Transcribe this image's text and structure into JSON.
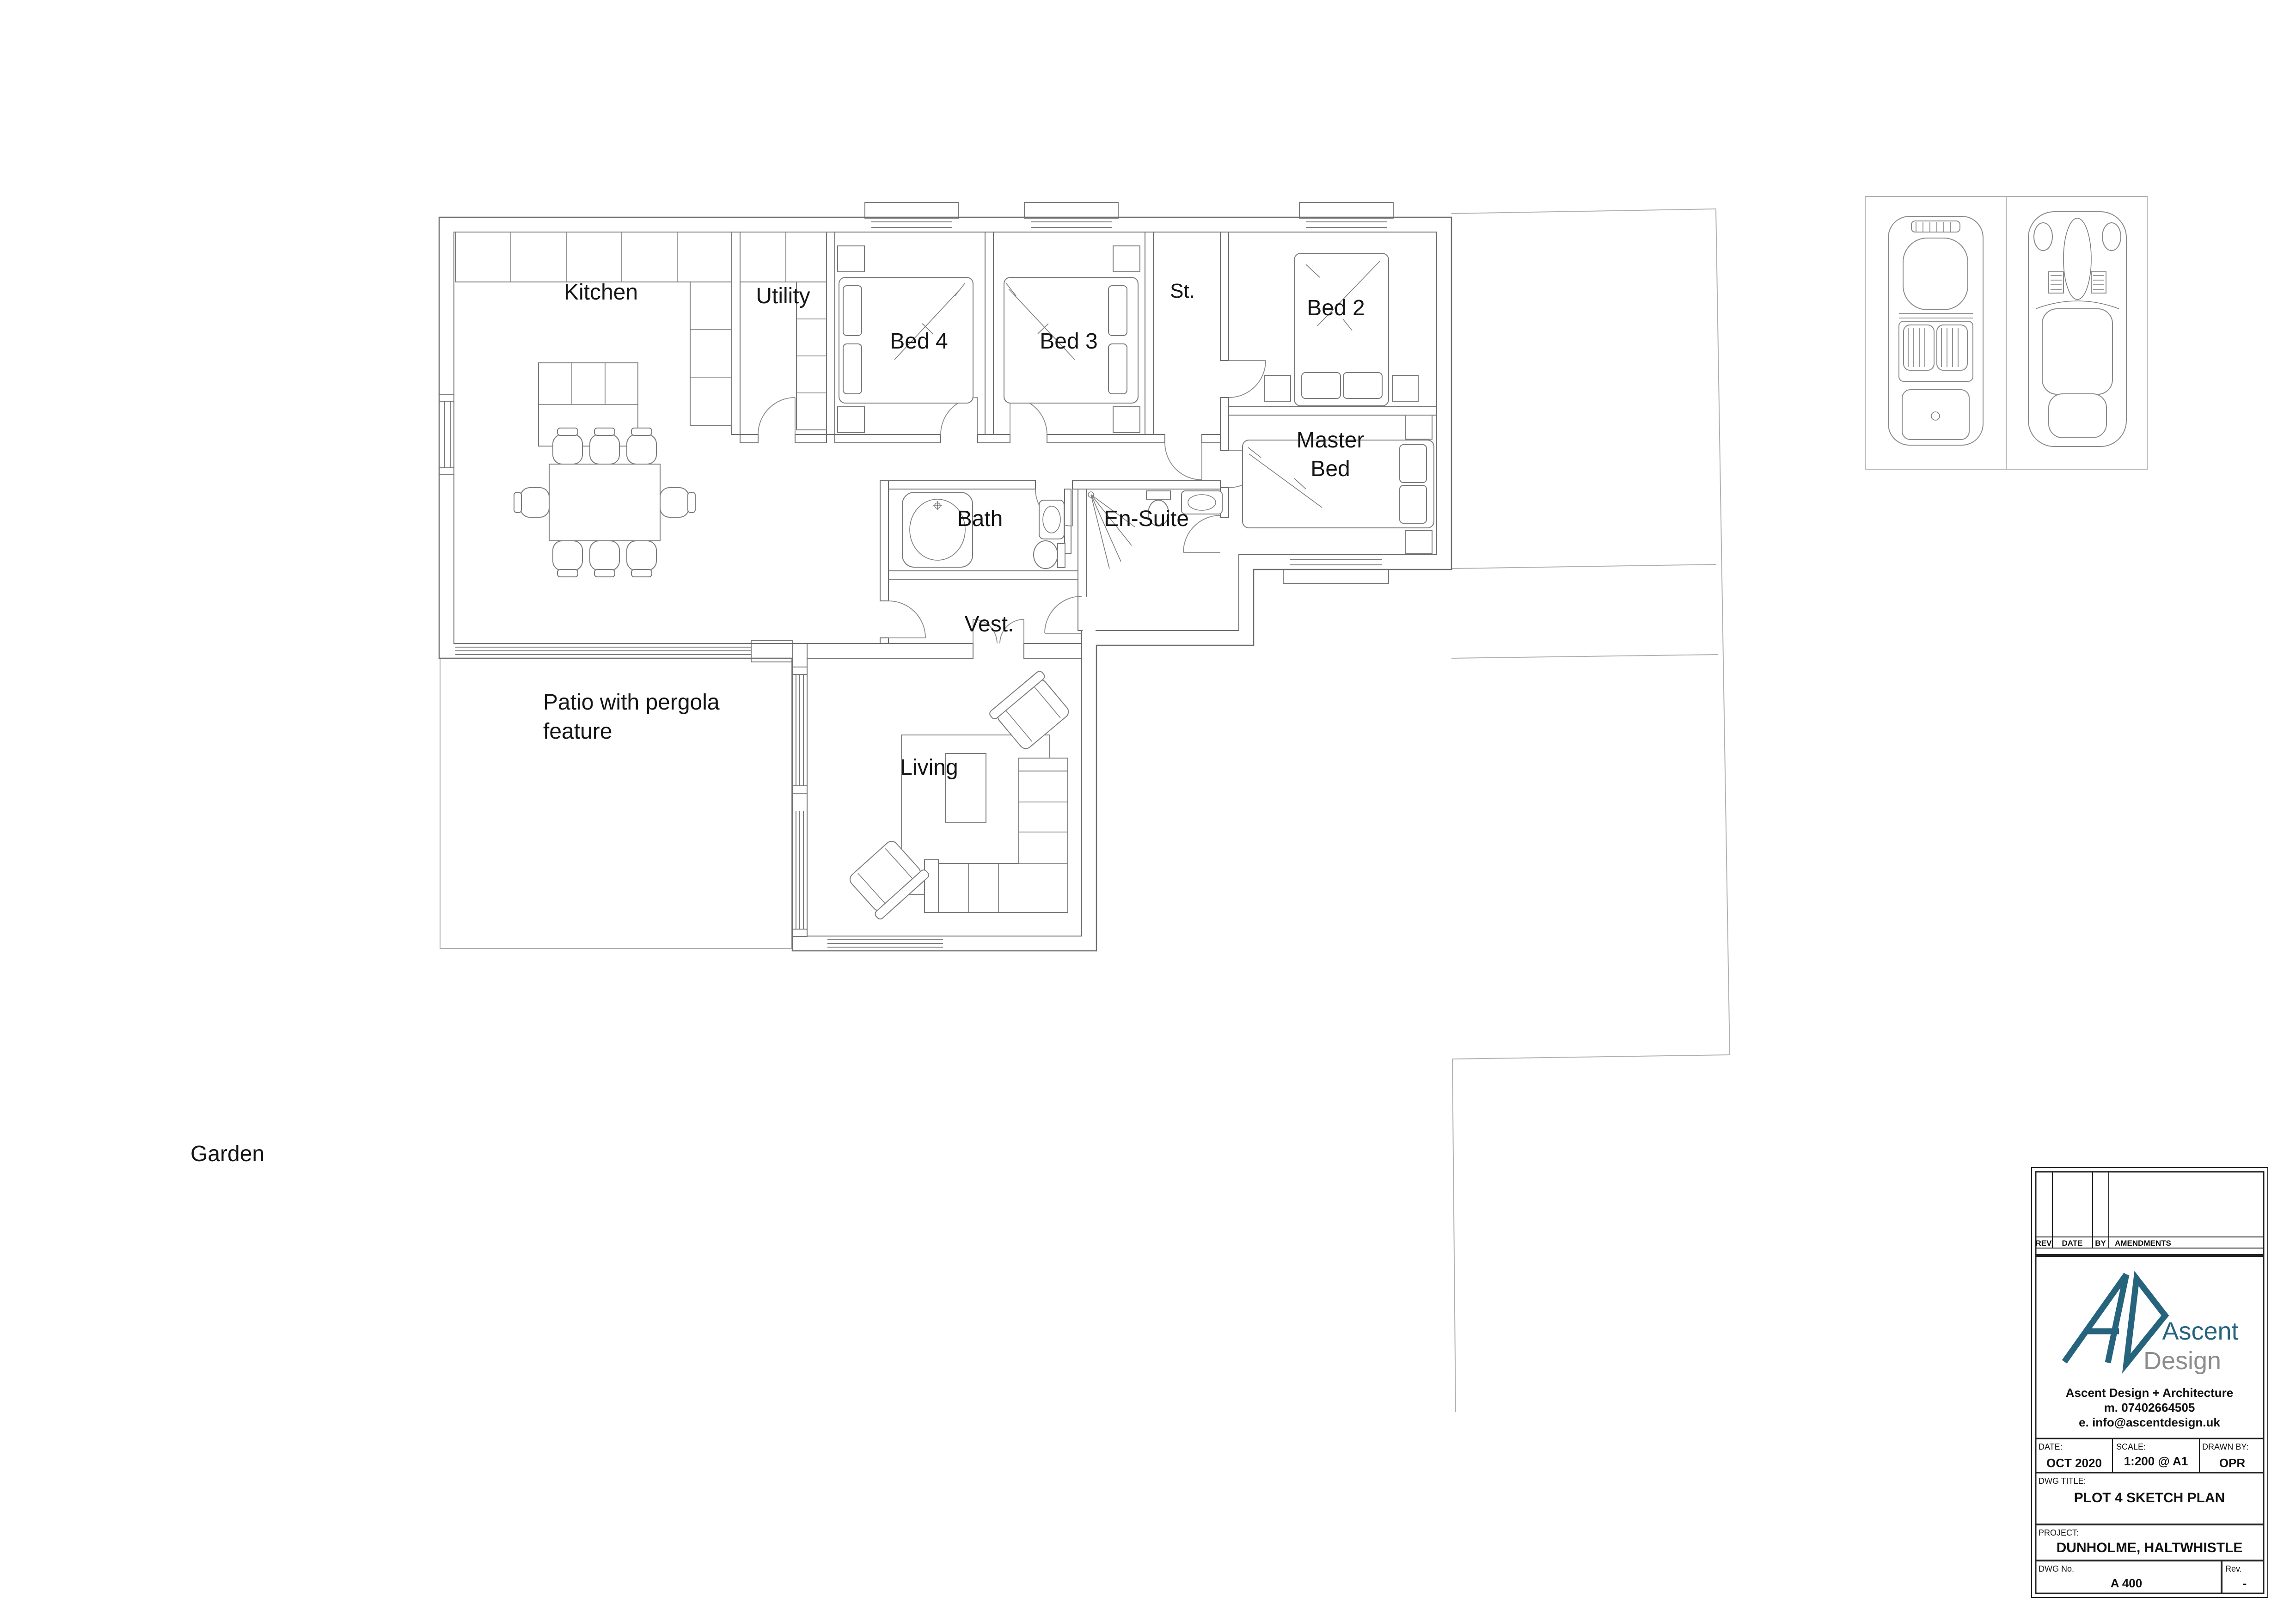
{
  "plan": {
    "labels": {
      "kitchen": "Kitchen",
      "utility": "Utility",
      "bed4": "Bed 4",
      "bed3": "Bed 3",
      "st": "St.",
      "bed2": "Bed 2",
      "master_line1": "Master",
      "master_line2": "Bed",
      "bath": "Bath",
      "ensuite": "En-Suite",
      "vest": "Vest.",
      "living": "Living",
      "patio_line1": "Patio with pergola",
      "patio_line2": "feature",
      "garden": "Garden"
    },
    "icons": {
      "car_left": "classic-convertible-top-view",
      "car_right": "coupe-car-top-view"
    }
  },
  "title_block": {
    "revision_table": {
      "col_rev": "REV",
      "col_date": "DATE",
      "col_by": "BY",
      "col_amendments": "AMENDMENTS"
    },
    "logo": {
      "brand_line1": "Ascent",
      "brand_line2": "Design",
      "accent_color": "#26647e",
      "gray_color": "#8c8c8c"
    },
    "contact": {
      "line1": "Ascent Design + Architecture",
      "line2": "m. 07402664505",
      "line3": "e. info@ascentdesign.uk"
    },
    "fields": {
      "date_label": "DATE:",
      "date_value": "OCT 2020",
      "scale_label": "SCALE:",
      "scale_value": "1:200 @ A1",
      "drawn_by_label": "DRAWN BY:",
      "drawn_by_value": "OPR",
      "dwg_title_label": "DWG TITLE:",
      "dwg_title_value": "PLOT 4 SKETCH PLAN",
      "project_label": "PROJECT:",
      "project_value": "DUNHOLME, HALTWHISTLE",
      "dwg_no_label": "DWG No.",
      "dwg_no_value": "A 400",
      "rev_label": "Rev.",
      "rev_value": "-"
    }
  }
}
